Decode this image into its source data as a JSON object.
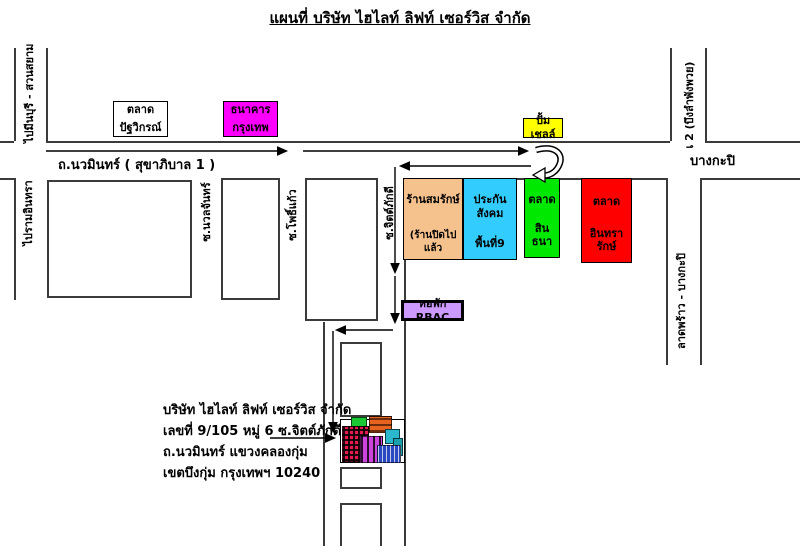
{
  "title": "แผนที่  บริษัท ไฮไลท์ ลิฟท์ เซอร์วิส  จำกัด",
  "road_labels": {
    "nawamin": "ถ.นวมินทร์ ( สุขาภิบาล 1 )",
    "bangkapi": "บางกะปิ",
    "to_minburi": "ไปมีนบุรี - สวนสยาม",
    "bueng_lam_phang_phuai": "เ 2 (บึงลำพังพวย)",
    "to_raminthra": "ไปรามอินทรา",
    "soi_nuanchan": "ซ.นวลจันทร์",
    "soi_phokaew": "ซ.โพธิ์แก้ว",
    "soi_chitphakdi": "ซ.จิตต์ภักดี",
    "latphrao_bangkapi": "ลาดพร้าว - บางกะปิ"
  },
  "places": {
    "patwikorn_market": {
      "line1": "ตลาด",
      "line2": "ปัฐวิกรณ์",
      "color": "#FFFFFF"
    },
    "bangkok_bank": {
      "line1": "ธนาคาร",
      "line2": "กรุงเทพ",
      "color": "#FF00FF"
    },
    "shell_station": {
      "label": "ปั้มเชลล์",
      "color": "#FFFF00"
    },
    "somrak_shop": {
      "line1": "ร้านสมรักษ์",
      "line2": "(ร้านปิดไปแล้ว",
      "color": "#F5C28E"
    },
    "social_security_area9": {
      "line1": "ประกันสังคม",
      "line2": "พื้นที่9",
      "color": "#33CCFF"
    },
    "sinthana_market": {
      "line1": "ตลาด",
      "line2": "สินธนา",
      "color": "#00E800"
    },
    "intharark_market": {
      "line1": "ตลาด",
      "line2": "อินทรารักษ์",
      "color": "#FF0000"
    },
    "rbac_dormitory": {
      "label": "หอพัก  RBAC",
      "color": "#CC99FF"
    }
  },
  "company_address": {
    "line1": "บริษัท ไฮไลท์ ลิฟท์ เซอร์วิส  จำกัด",
    "line2": "เลขที่  9/105  หมู่ 6  ซ.จิตต์ภักดี",
    "line3": "ถ.นวมินทร์  แขวงคลองกุ่ม",
    "line4": "เขตบึงกุ่ม  กรุงเทพฯ 10240"
  },
  "line_color": "#3b3b3b"
}
